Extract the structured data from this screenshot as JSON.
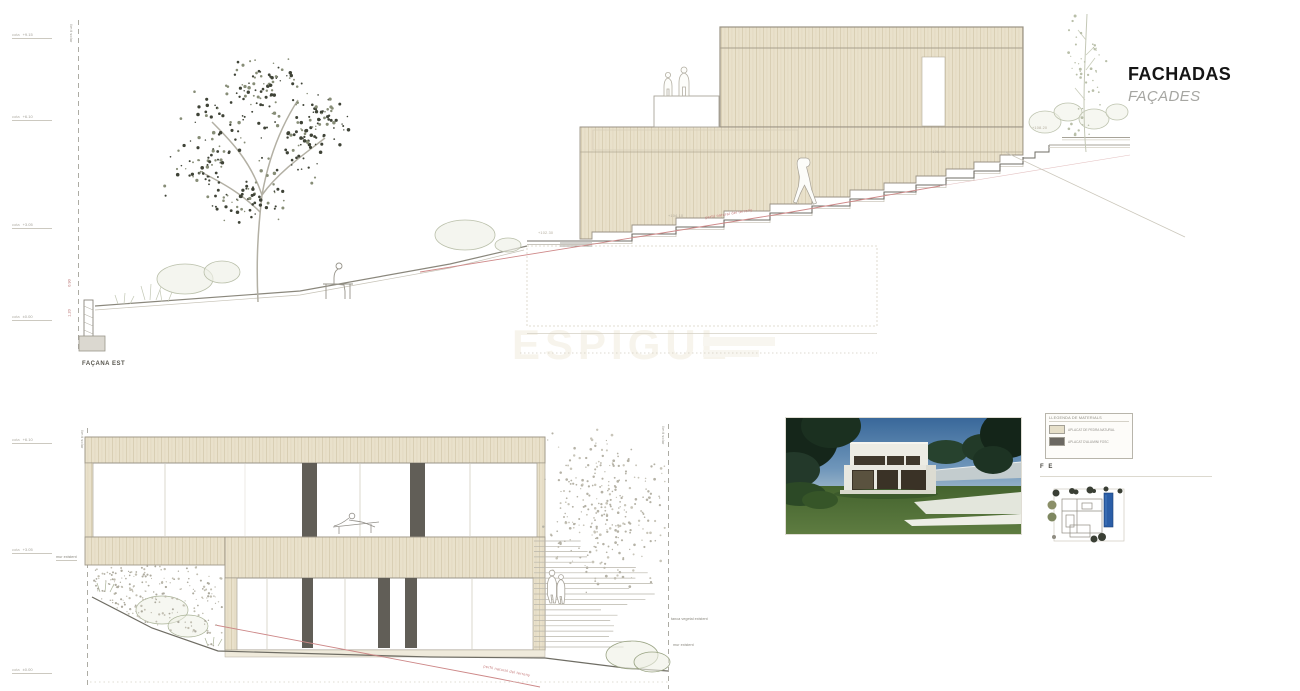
{
  "title_block": {
    "title": "FACHADAS",
    "subtitle": "FAÇADES"
  },
  "watermark": {
    "text": "ESPIGUL"
  },
  "top_elevation": {
    "label": "FAÇANA EST",
    "site_boundary_label": "límit solar",
    "terrain_label": "perfil natural del terreny",
    "levels": [
      {
        "name": "cota",
        "value": "+9.15"
      },
      {
        "name": "cota",
        "value": "+6.10"
      },
      {
        "name": "cota",
        "value": "+3.05"
      },
      {
        "name": "cota",
        "value": "±0.00"
      }
    ],
    "step_labels": [
      "+102.30",
      "+104.10",
      "+106.40",
      "+108.20"
    ],
    "wall_dims": [
      "0.90",
      "1.20"
    ]
  },
  "bottom_elevation": {
    "site_boundary_label": "límit solar",
    "terrain_label": "perfil natural del terreny",
    "levels": [
      {
        "name": "cota",
        "value": "+6.10"
      },
      {
        "name": "cota",
        "value": "+3.05"
      },
      {
        "name": "cota",
        "value": "±0.00"
      }
    ],
    "wall_label": "mur existent",
    "annotations": [
      "tanca vegetal existent",
      "mur existent"
    ]
  },
  "legend": {
    "title": "LLEGENDA DE MATERIALS",
    "items": [
      {
        "color": "#e6dfc9",
        "label": "APLACAT DE PEDRA NATURAL"
      },
      {
        "color": "#6b6862",
        "label": "APLACAT D'ALUMINI FOSC"
      }
    ],
    "code": "F E"
  }
}
